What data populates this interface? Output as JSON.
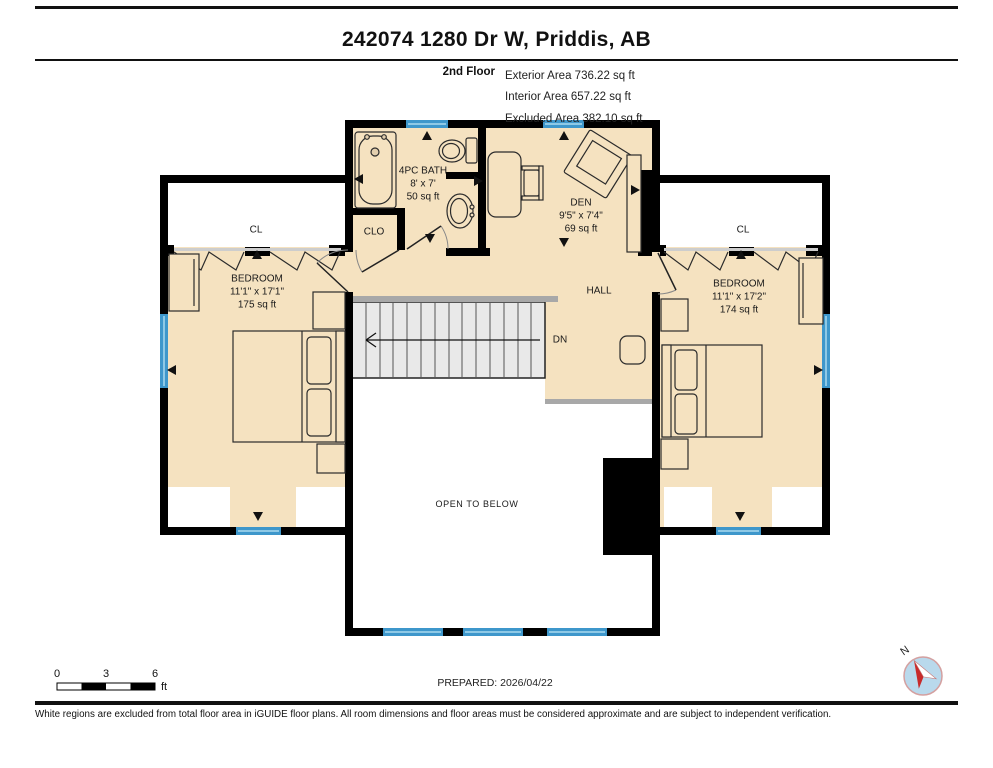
{
  "header": {
    "title": "242074 1280 Dr W, Priddis, AB",
    "floor_label": "2nd Floor",
    "area_lines": [
      "Exterior Area 736.22 sq ft",
      "Interior Area 657.22 sq ft",
      "Excluded Area 382.10 sq ft"
    ]
  },
  "rooms": {
    "bath": {
      "name": "4PC BATH",
      "dims": "8' x 7'",
      "area": "50 sq ft"
    },
    "den": {
      "name": "DEN",
      "dims": "9'5\" x 7'4\"",
      "area": "69 sq ft"
    },
    "bedroom_left": {
      "name": "BEDROOM",
      "dims": "11'1\" x 17'1\"",
      "area": "175 sq ft"
    },
    "bedroom_right": {
      "name": "BEDROOM",
      "dims": "11'1\" x 17'2\"",
      "area": "174 sq ft"
    },
    "hall": {
      "name": "HALL"
    },
    "closet": {
      "name": "CLO"
    },
    "cl_left": {
      "name": "CL"
    },
    "cl_right": {
      "name": "CL"
    },
    "open_below": {
      "name": "OPEN TO BELOW"
    },
    "stairs": {
      "label": "DN"
    }
  },
  "scale_bar": {
    "ticks": [
      "0",
      "3",
      "6"
    ],
    "unit": "ft"
  },
  "footer": {
    "prepared": "PREPARED: 2026/04/22",
    "disclaimer": "White regions are excluded from total floor area in iGUIDE floor plans. All room dimensions and floor areas must be considered approximate and are subject to independent verification.",
    "compass": "N"
  },
  "colors": {
    "floor": "#f5e2c0",
    "wall": "#000000",
    "window": "#3e97cb",
    "window_light": "#8ec9e6",
    "stairs": "#e9e9e9",
    "railing": "#a8a8a8",
    "excluded": "#ffffff",
    "compass_fill": "#b9d9ec",
    "compass_needle": "#c82a2a"
  }
}
